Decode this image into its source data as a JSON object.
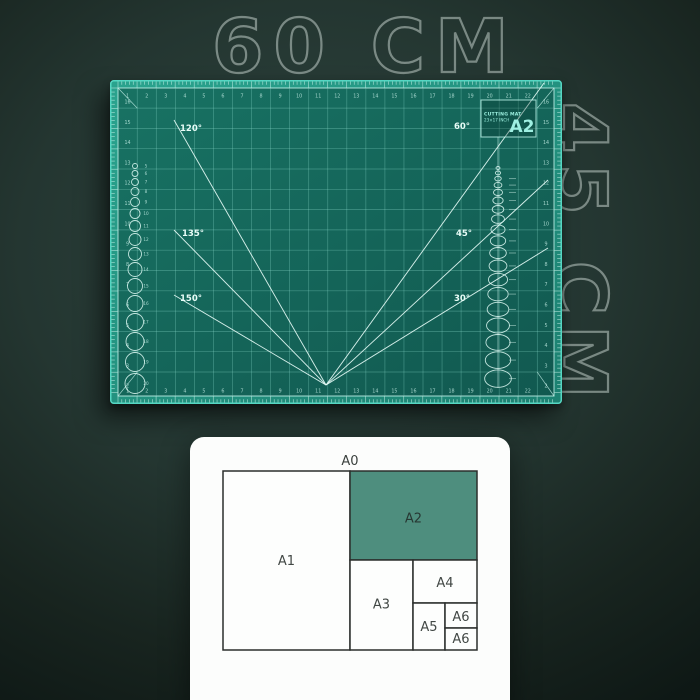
{
  "scene": {
    "width_label": "60 СМ",
    "height_label": "45 СМ",
    "background_color": "#223530"
  },
  "mat": {
    "title_line1": "CUTTING MAT",
    "title_line2": "23×17 INCH",
    "size_badge": "A2",
    "angle_labels": {
      "left": [
        "120°",
        "135°",
        "150°"
      ],
      "right": [
        "60°",
        "45°",
        "30°"
      ]
    },
    "column_numbers": [
      "1",
      "2",
      "3",
      "4",
      "5",
      "6",
      "7",
      "8",
      "9",
      "10",
      "11",
      "12",
      "13",
      "14",
      "15",
      "16",
      "17",
      "18",
      "19",
      "20",
      "21",
      "22"
    ],
    "row_numbers": [
      "16",
      "15",
      "14",
      "13",
      "12",
      "11",
      "10",
      "9",
      "8",
      "7",
      "6",
      "5",
      "4",
      "3",
      "2"
    ],
    "circle_labels": [
      "5",
      "6",
      "7",
      "8",
      "9",
      "10",
      "11",
      "12",
      "13",
      "14",
      "15",
      "16",
      "17",
      "18",
      "19",
      "20"
    ],
    "colors": {
      "body": "#14695e",
      "edge_band": "#23937f",
      "edge_highlight": "#55d7c3",
      "grid_line": "#8cdccd",
      "marking": "#e9fdf8",
      "badge_text": "#9ff0e2"
    }
  },
  "size_chart": {
    "labels": {
      "a0": "A0",
      "a1": "A1",
      "a2": "A2",
      "a3": "A3",
      "a4": "A4",
      "a5": "A5",
      "a6_top": "A6",
      "a6_bottom": "A6"
    },
    "highlighted_size": "A2",
    "highlight_color": "#4e8e7e",
    "card_color": "#fcfdfc"
  }
}
